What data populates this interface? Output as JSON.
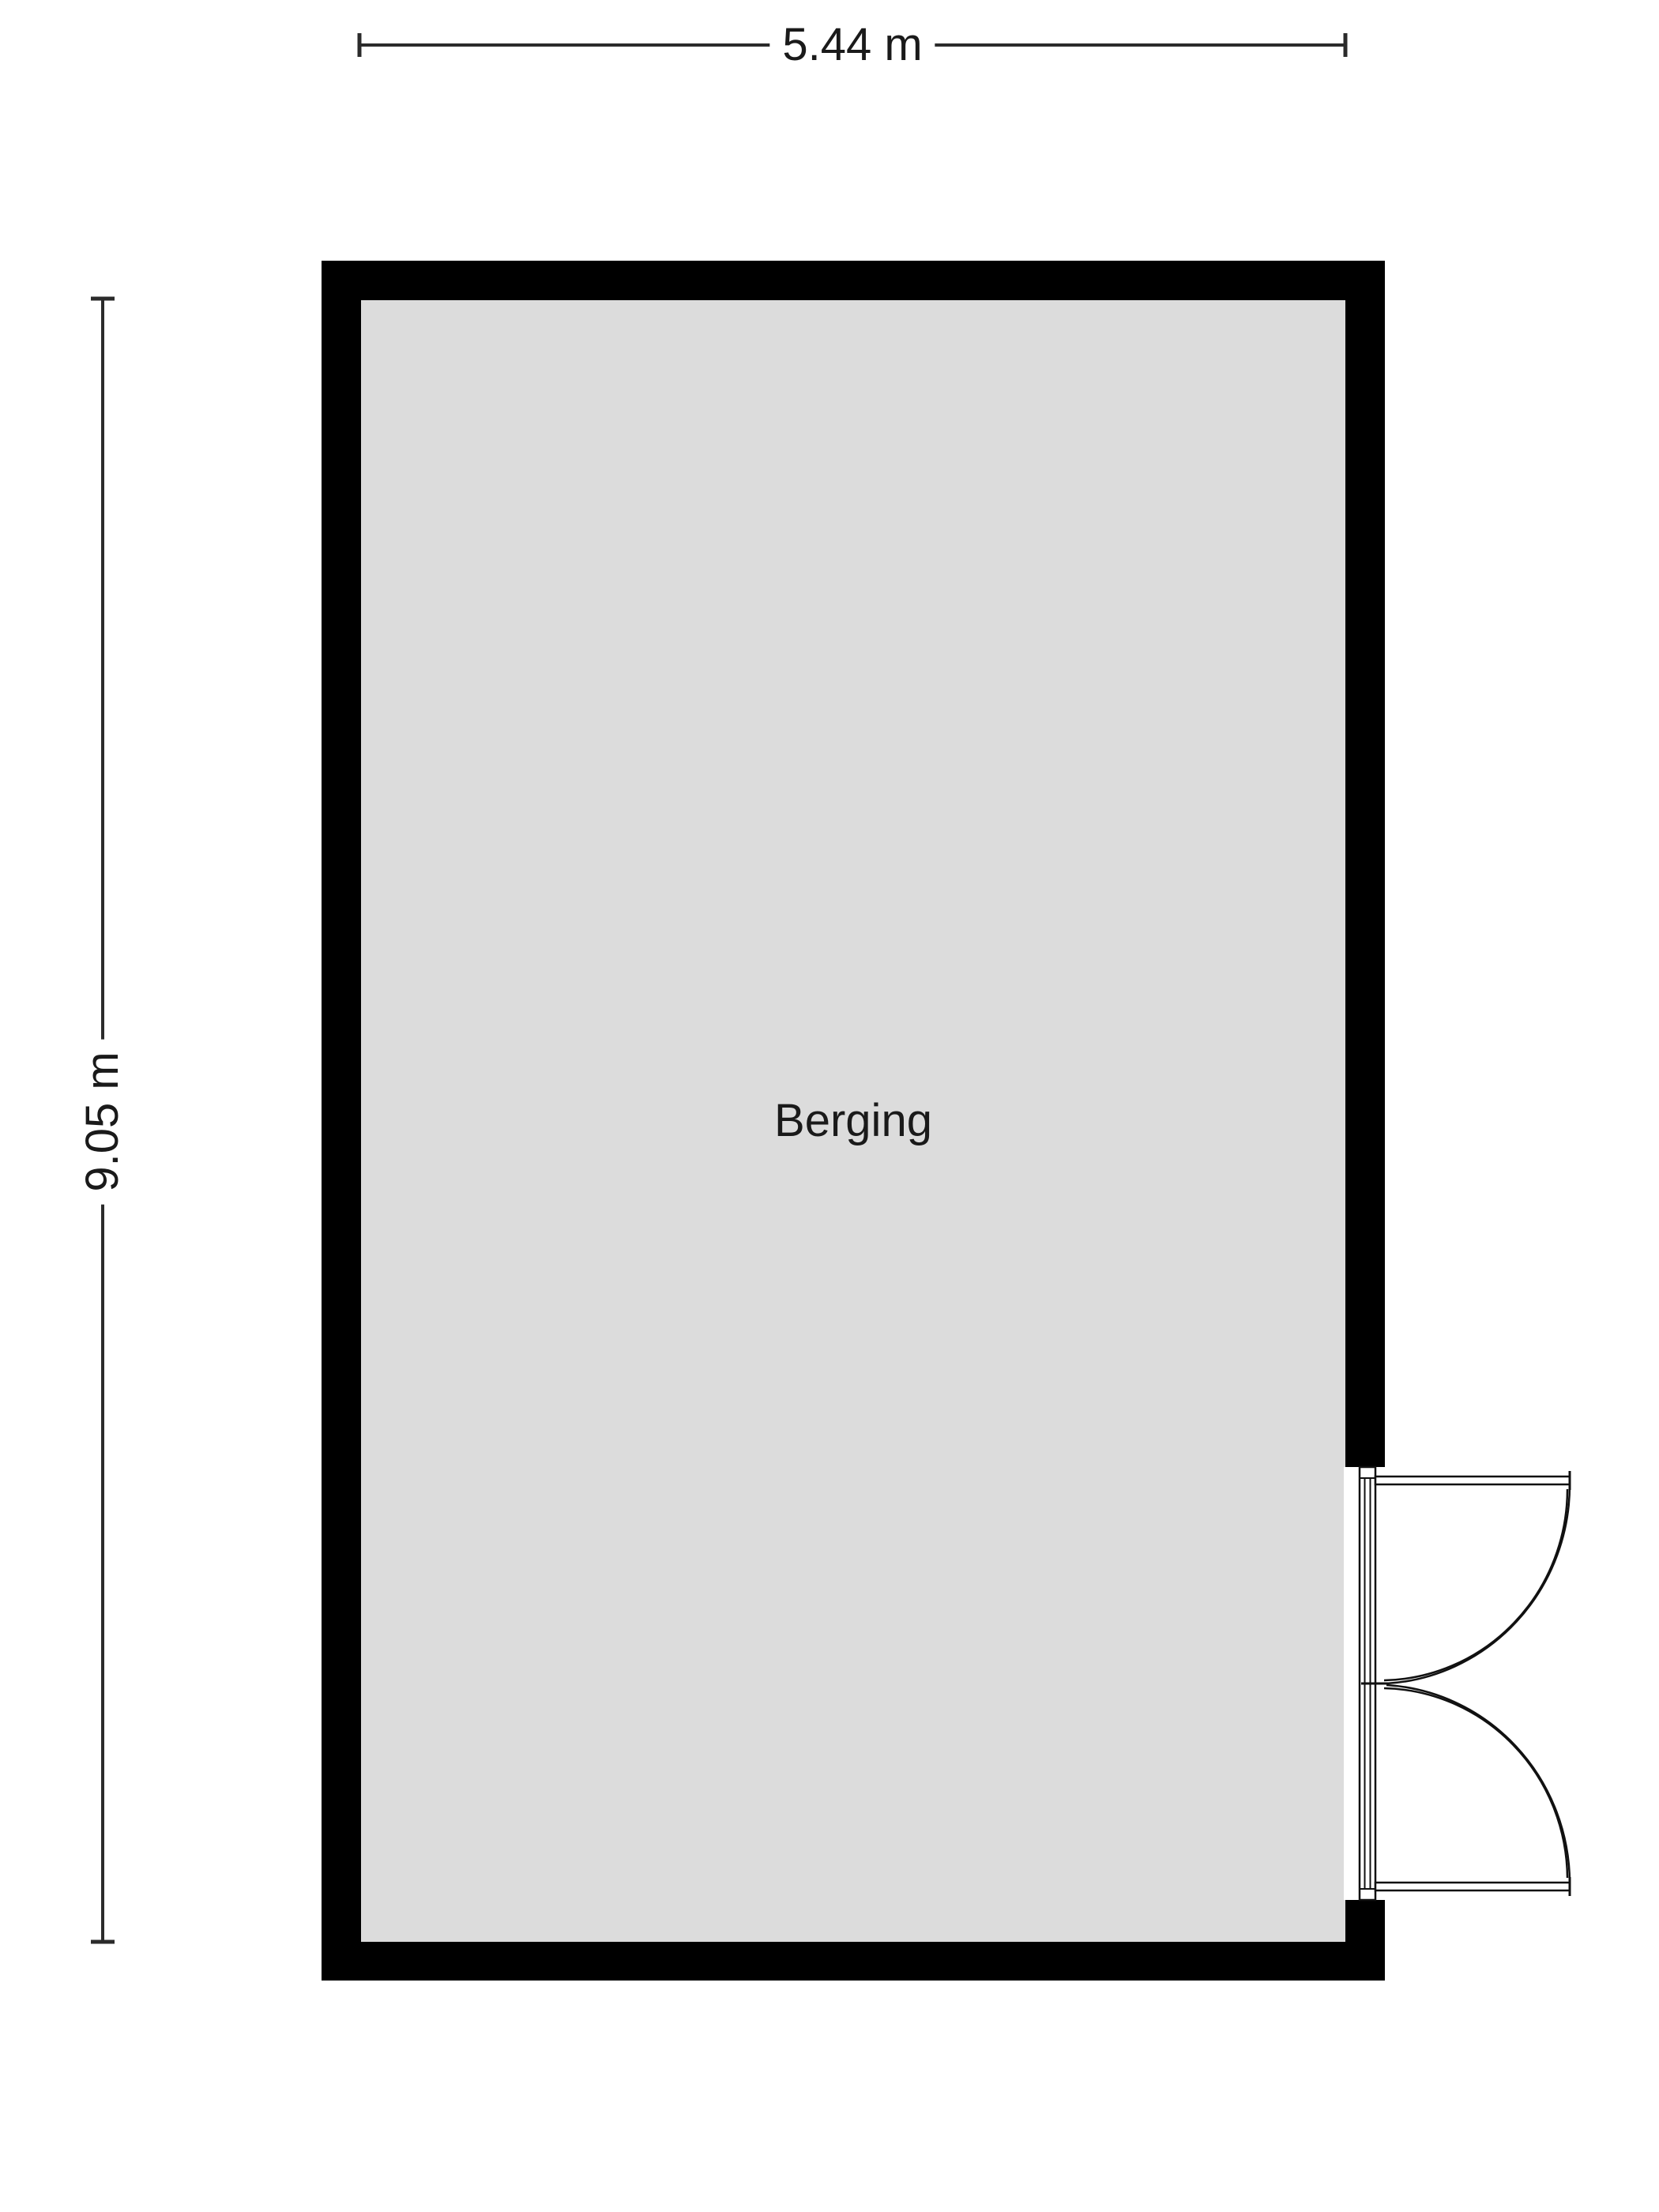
{
  "floor_plan": {
    "room": {
      "name": "Berging"
    },
    "dimensions": {
      "width": "5.44 m",
      "height": "9.05 m"
    },
    "door": {
      "type": "double-swing-door",
      "location": "right-wall-bottom"
    },
    "colors": {
      "background": "#ffffff",
      "wall": "#000000",
      "floor": "#dcdcdc",
      "dimension_line": "#2b2b2b",
      "door_line": "#111111",
      "text": "#1a1a1a"
    }
  }
}
